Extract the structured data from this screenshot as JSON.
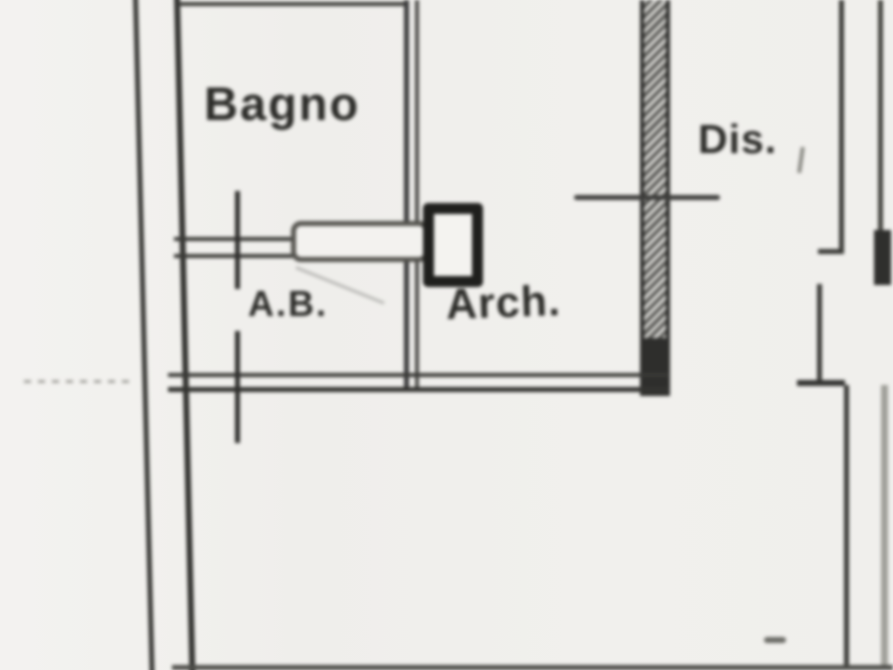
{
  "document": {
    "type": "scanned floor plan",
    "language": "it"
  },
  "rooms": [
    {
      "id": "bagno",
      "label": "Bagno"
    },
    {
      "id": "antibagno",
      "label": "A.B."
    },
    {
      "id": "arch",
      "label": "Arch."
    },
    {
      "id": "disimpegno",
      "label": "Dis."
    }
  ],
  "colors": {
    "paper": "#f1f0ed",
    "ink": "#32322f",
    "faint_ink": "#9a9a94"
  }
}
